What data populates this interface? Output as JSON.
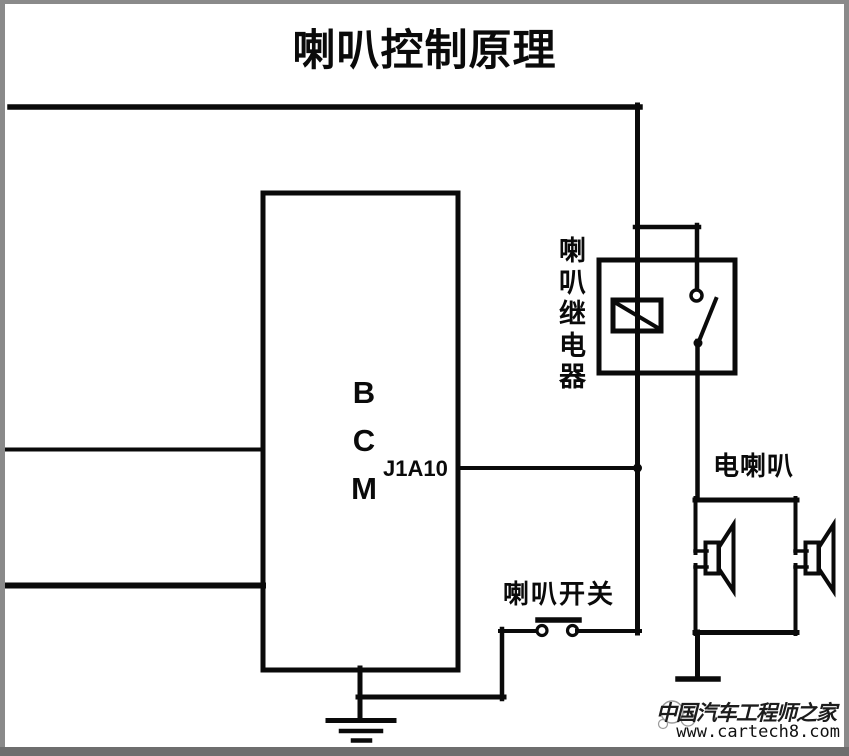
{
  "title": "喇叭控制原理",
  "diagram": {
    "bcm_label": "BCM",
    "bcm_pin": "J1A10",
    "relay_label": "喇叭继电器",
    "horn_label": "电喇叭",
    "switch_label": "喇叭开关"
  },
  "watermark": {
    "site_name": "中国汽车工程师之家",
    "site_url": "www.cartech8.com"
  },
  "colors": {
    "line": "#0a0a0a",
    "border": "#8a8a8a",
    "bottom_bar": "#6e6e6e",
    "background": "#ffffff"
  }
}
